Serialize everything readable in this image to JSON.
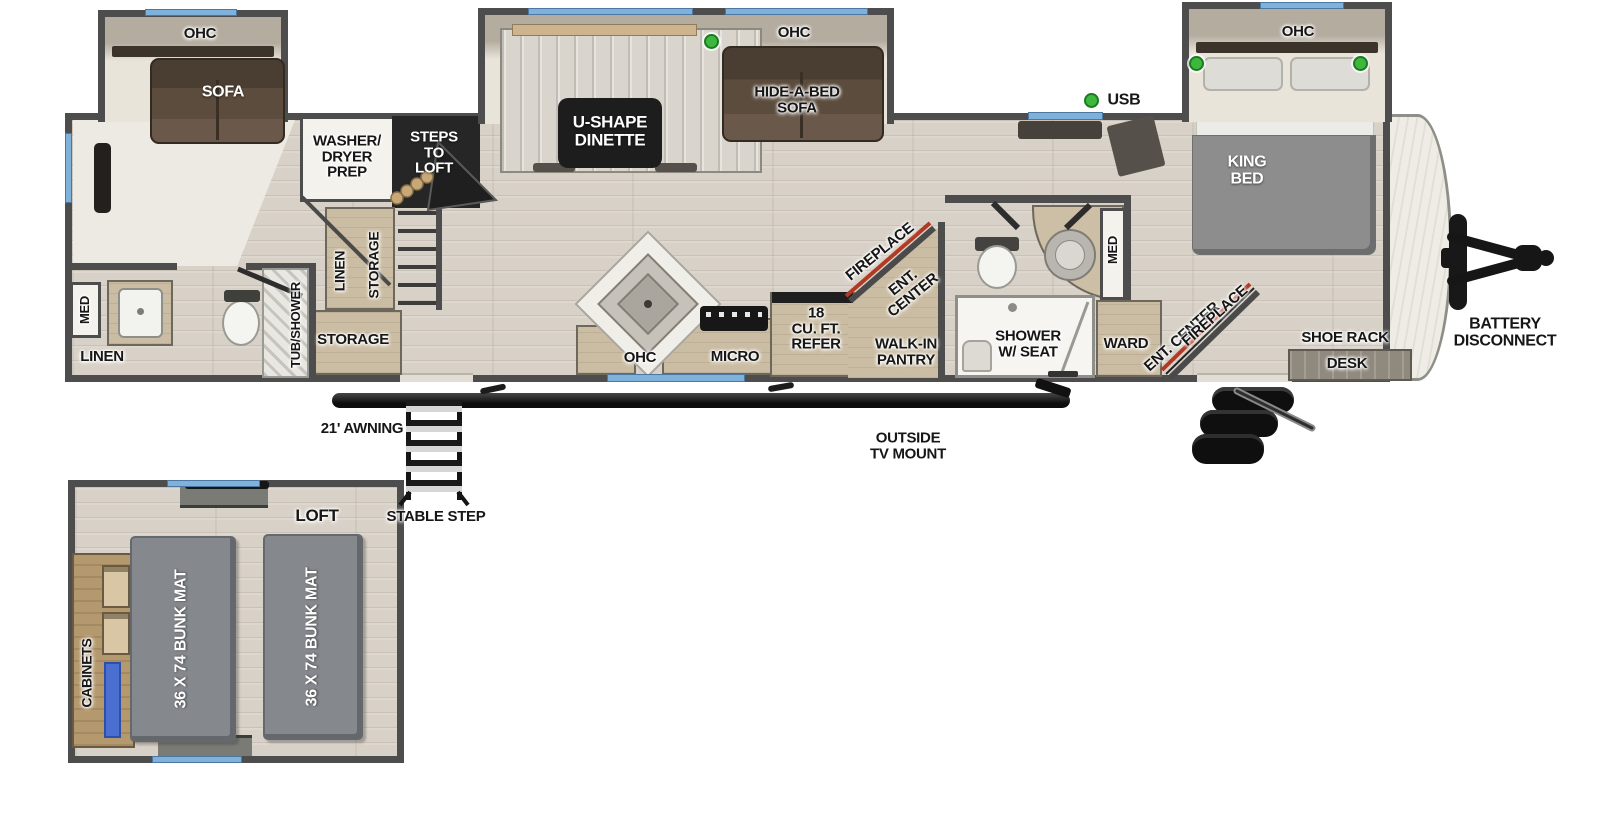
{
  "title": "Travel trailer floorplan",
  "colors": {
    "wall": "#4d4d4d",
    "floor_wood": "#d8d1c7",
    "window_accent": "#7fb2da",
    "indicator_green": "#3db83d",
    "fireplace_red": "#b23a25",
    "bed_gray": "#8d8d8d",
    "cabinet_tan": "#cbbda3"
  },
  "plan": {
    "front_slide": {
      "ohc": "OHC",
      "sofa": "SOFA"
    },
    "dinette_slide": {
      "dinette": "U-SHAPE\nDINETTE",
      "ohc": "OHC",
      "hide_a_bed": "HIDE-A-BED\nSOFA"
    },
    "bedroom_slide": {
      "ohc": "OHC",
      "king_bed": "KING\nBED"
    },
    "mid": {
      "usb": "USB",
      "washer_dryer": "WASHER/\nDRYER\nPREP",
      "steps_to_loft": "STEPS\nTO\nLOFT",
      "linen": "LINEN",
      "storage_closet": "STORAGE",
      "storage": "STORAGE"
    },
    "front_bath": {
      "med": "MED",
      "linen": "LINEN",
      "tub_shower": "TUB/SHOWER"
    },
    "kitchen": {
      "ohc": "OHC",
      "micro": "MICRO",
      "refer": "18\nCU. FT.\nREFER",
      "fireplace": "FIREPLACE",
      "ent_center": "ENT.\nCENTER",
      "pantry": "WALK-IN\nPANTRY"
    },
    "bath": {
      "shower": "SHOWER\nW/ SEAT",
      "med": "MED"
    },
    "bedroom": {
      "ward": "WARD",
      "ent_center": "ENT. CENTER",
      "fireplace": "FIREPLACE",
      "shoe_rack": "SHOE RACK",
      "desk": "DESK"
    },
    "exterior": {
      "battery": "BATTERY\nDISCONNECT",
      "awning": "21' AWNING",
      "stable_step": "STABLE STEP",
      "outside_tv": "OUTSIDE\nTV MOUNT"
    },
    "loft": {
      "title": "LOFT",
      "cabinets": "CABINETS",
      "bunk_left": "36 X 74 BUNK MAT",
      "bunk_right": "36 X 74 BUNK MAT"
    }
  }
}
